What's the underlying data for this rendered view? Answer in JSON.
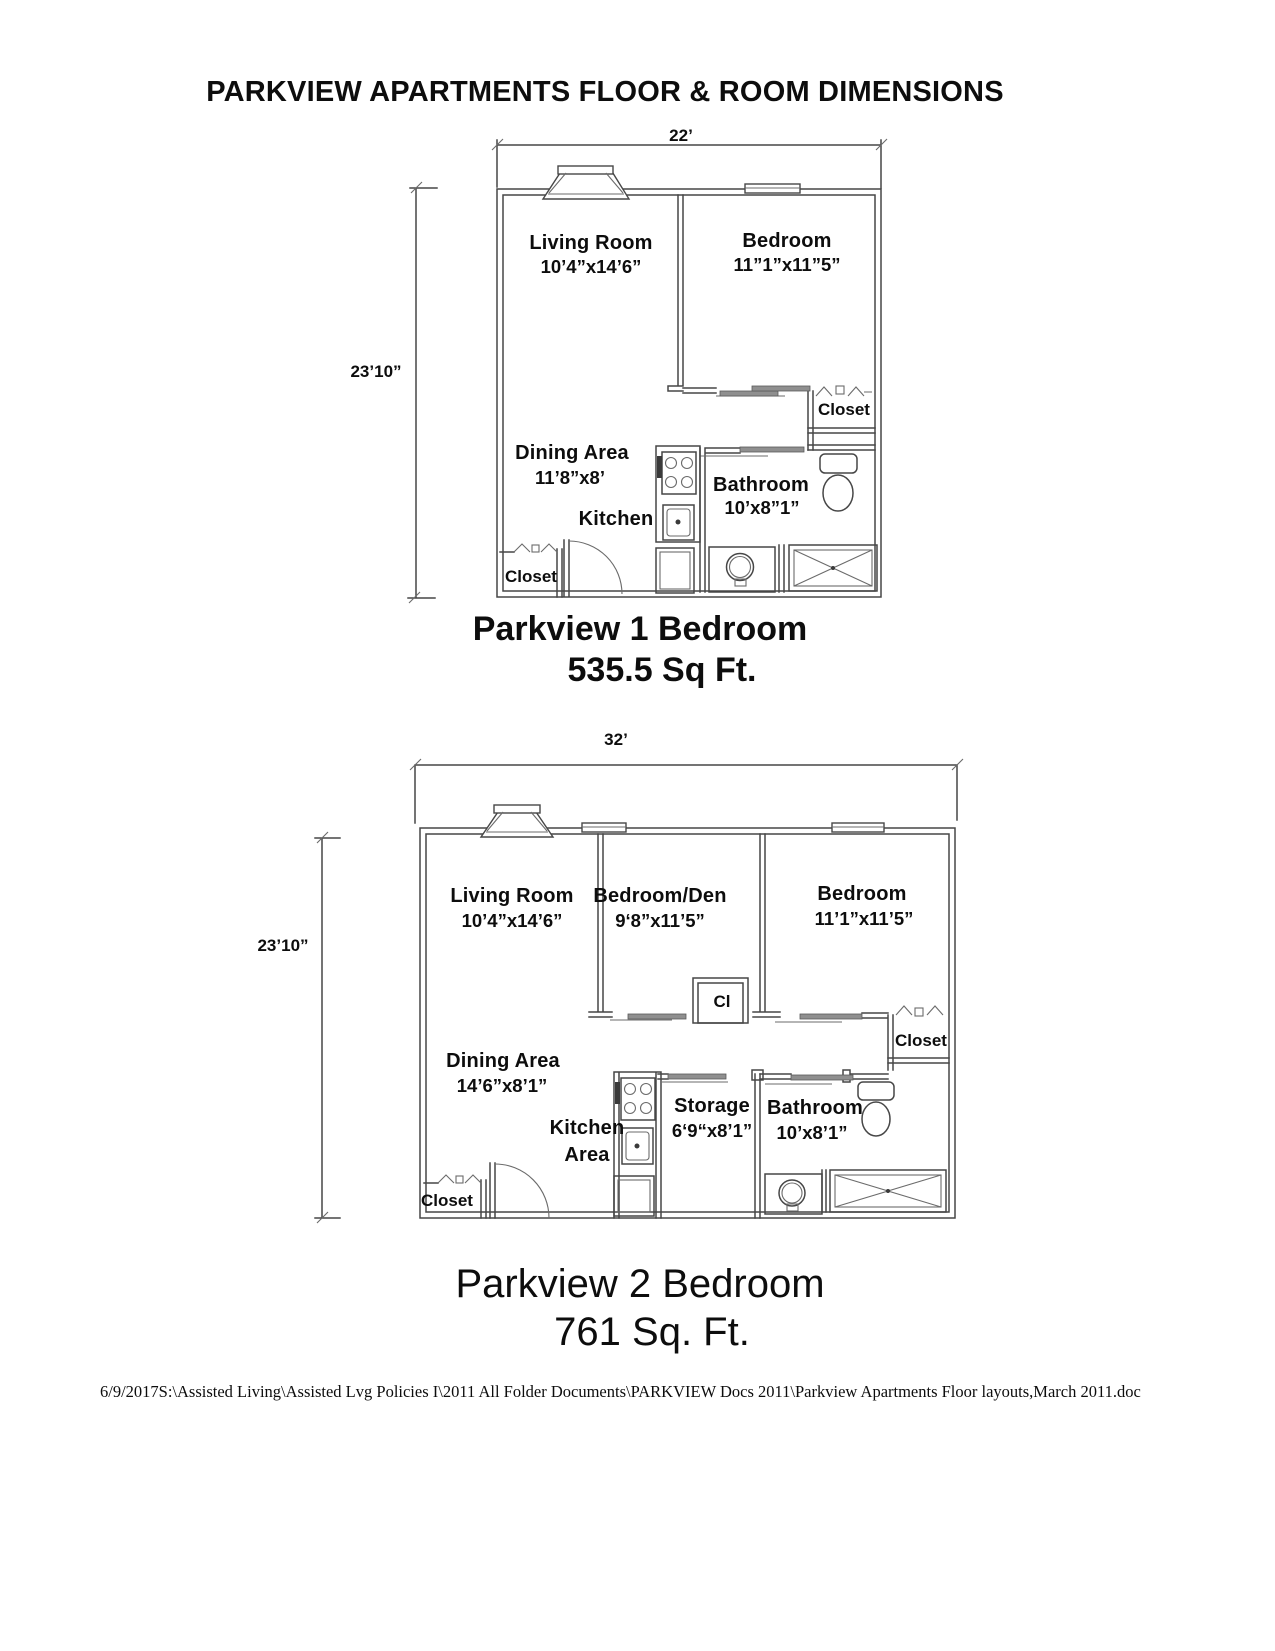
{
  "page": {
    "title": "PARKVIEW APARTMENTS FLOOR & ROOM DIMENSIONS",
    "footer_path": "6/9/2017S:\\Assisted Living\\Assisted Lvg Policies I\\2011 All Folder Documents\\PARKVIEW Docs 2011\\Parkview Apartments Floor layouts,March 2011.doc"
  },
  "plan1": {
    "caption_title": "Parkview 1 Bedroom",
    "caption_area": "535.5 Sq Ft.",
    "width_dim": "22’",
    "height_dim": "23’10”",
    "labels": {
      "living_name": "Living Room",
      "living_dims": "10’4”x14’6”",
      "bedroom_name": "Bedroom",
      "bedroom_dims": "11”1”x11”5”",
      "dining_name": "Dining Area",
      "dining_dims": "11’8”x8’",
      "kitchen": "Kitchen",
      "bathroom_name": "Bathroom",
      "bathroom_dims": "10’x8”1”",
      "closet_bedroom": "Closet",
      "closet_entry": "Closet"
    }
  },
  "plan2": {
    "caption_title": "Parkview 2 Bedroom",
    "caption_area": "761 Sq. Ft.",
    "width_dim": "32’",
    "height_dim": "23’10”",
    "labels": {
      "living_name": "Living Room",
      "living_dims": "10’4”x14’6”",
      "den_name": "Bedroom/Den",
      "den_dims": "9‘8”x11’5”",
      "bedroom_name": "Bedroom",
      "bedroom_dims": "11’1”x11’5”",
      "dining_name": "Dining Area",
      "dining_dims": "14’6”x8’1”",
      "kitchen_line1": "Kitchen",
      "kitchen_line2": "Area",
      "storage_name": "Storage",
      "storage_dims": "6‘9“x8’1”",
      "bathroom_name": "Bathroom",
      "bathroom_dims": "10’x8’1”",
      "closet_small": "Cl",
      "closet_bedroom": "Closet",
      "closet_entry": "Closet"
    }
  }
}
